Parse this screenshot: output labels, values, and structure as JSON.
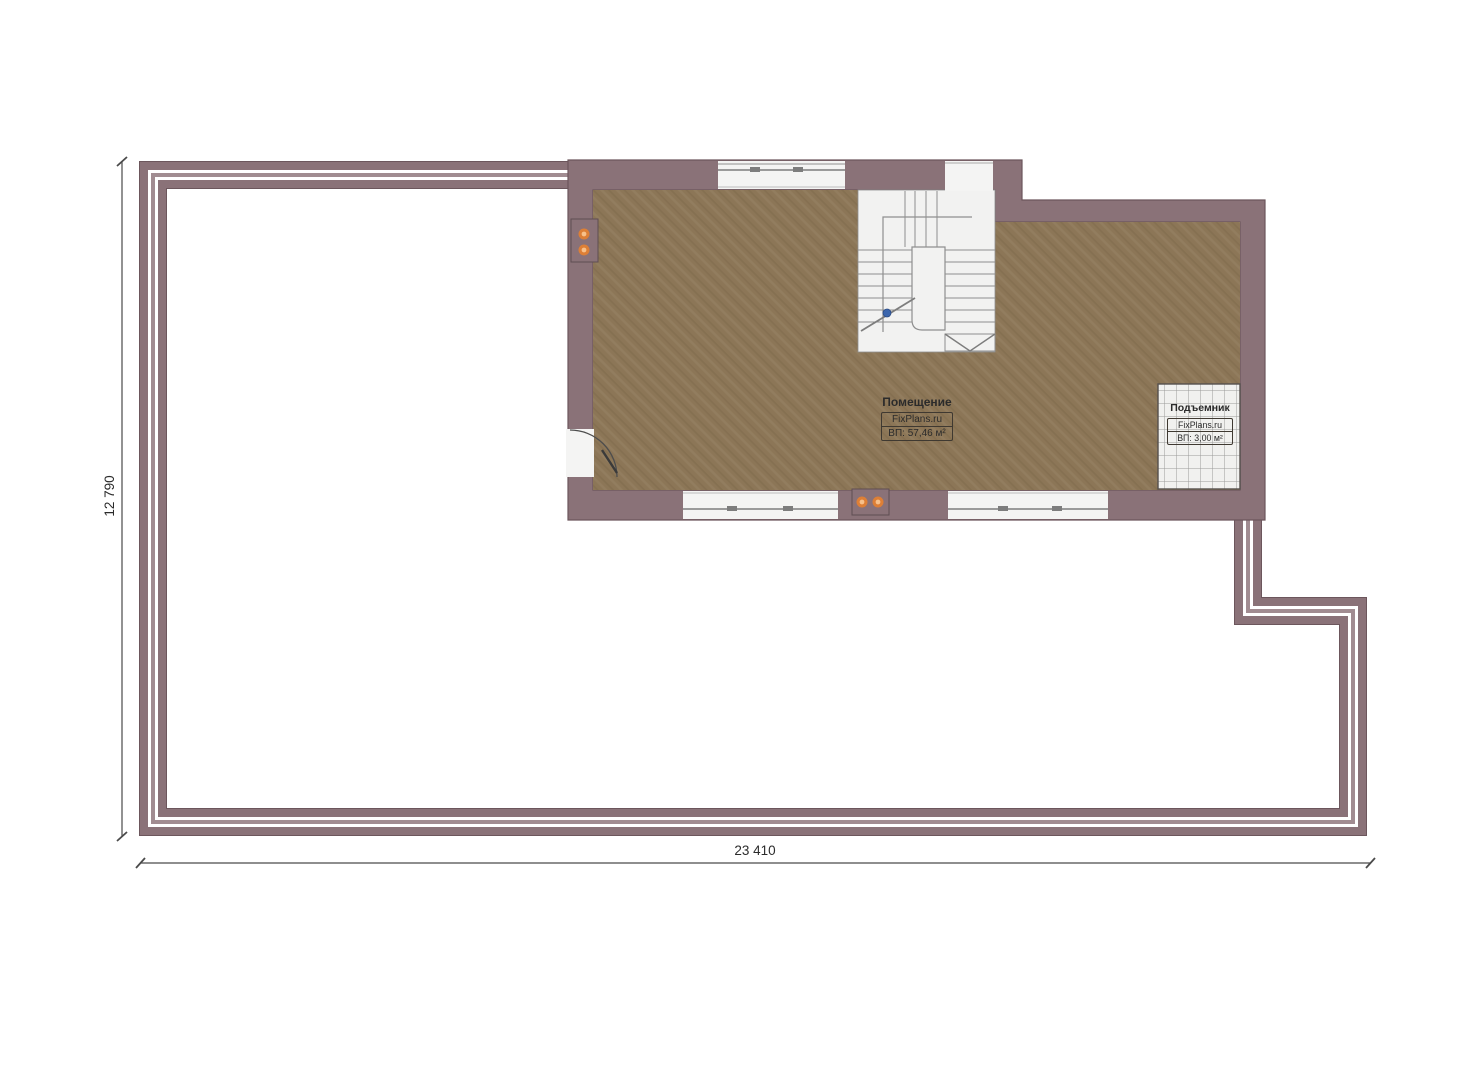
{
  "plan": {
    "room_label": {
      "title": "Помещение",
      "brand": "FixPlans.ru",
      "area": "ВП: 57,46 м²"
    },
    "lift_label": {
      "title": "Подъемник",
      "brand": "FixPlans.ru",
      "area": "ВП: 3,00 м²"
    },
    "dimensions": {
      "width": "23 410",
      "height": "12 790"
    }
  },
  "colors": {
    "wall": "#8a7278",
    "wall_outline": "#6c565c",
    "parapet_gray": "#a18c91",
    "parapet_white": "#ffffff",
    "floor": "#8c7657",
    "stair_bg": "#f2f2f1",
    "stair_line": "#8f8f8f",
    "tile_bg": "#f1f1ef",
    "tile_line": "#9a9a9a",
    "opening_bg": "#f4f4f3",
    "glazing_line": "#7d7d7d",
    "accent_orange": "#e5812f",
    "accent_orange_light": "#f7c08a",
    "accent_blue": "#3c66ad",
    "dim_line": "#4a4a4a",
    "text": "#2b2b2b"
  }
}
